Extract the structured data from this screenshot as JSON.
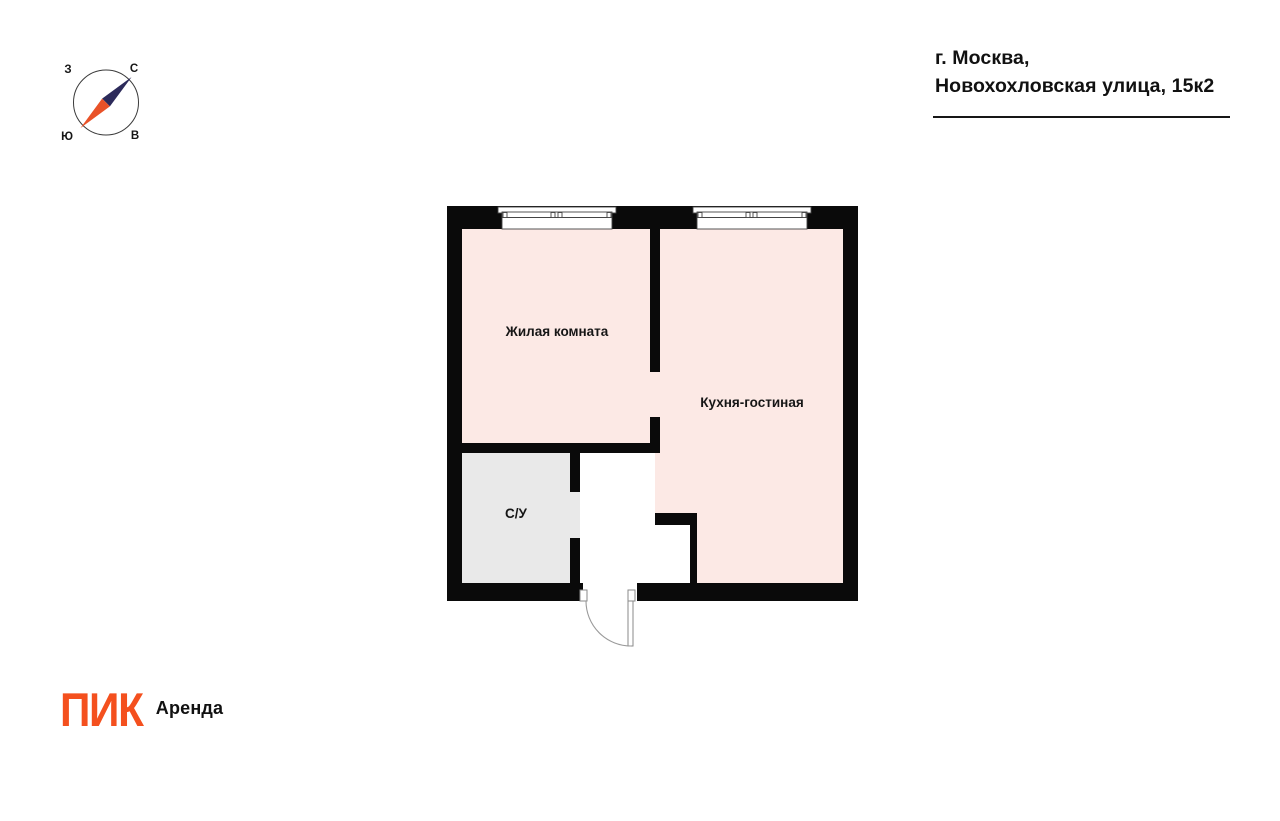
{
  "header": {
    "address_line1": "г. Москва,",
    "address_line2": "Новохохловская улица, 15к2"
  },
  "compass": {
    "north_label": "С",
    "south_label": "Ю",
    "west_label": "З",
    "east_label": "В"
  },
  "floorplan": {
    "rooms": [
      {
        "id": "living",
        "label": "Жилая комната"
      },
      {
        "id": "kitchen",
        "label": "Кухня-гостиная"
      },
      {
        "id": "bathroom",
        "label": "С/У"
      }
    ]
  },
  "branding": {
    "logo_text": "ПИК",
    "logo_suffix": "Аренда"
  },
  "colors": {
    "room-fill": "#fce9e5",
    "bathroom-fill": "#e9e9e9",
    "wall": "#0a0a0a",
    "accent-orange": "#f4501e",
    "needle-navy": "#2c2a5a",
    "needle-orange": "#e95228",
    "ink": "#111111"
  }
}
